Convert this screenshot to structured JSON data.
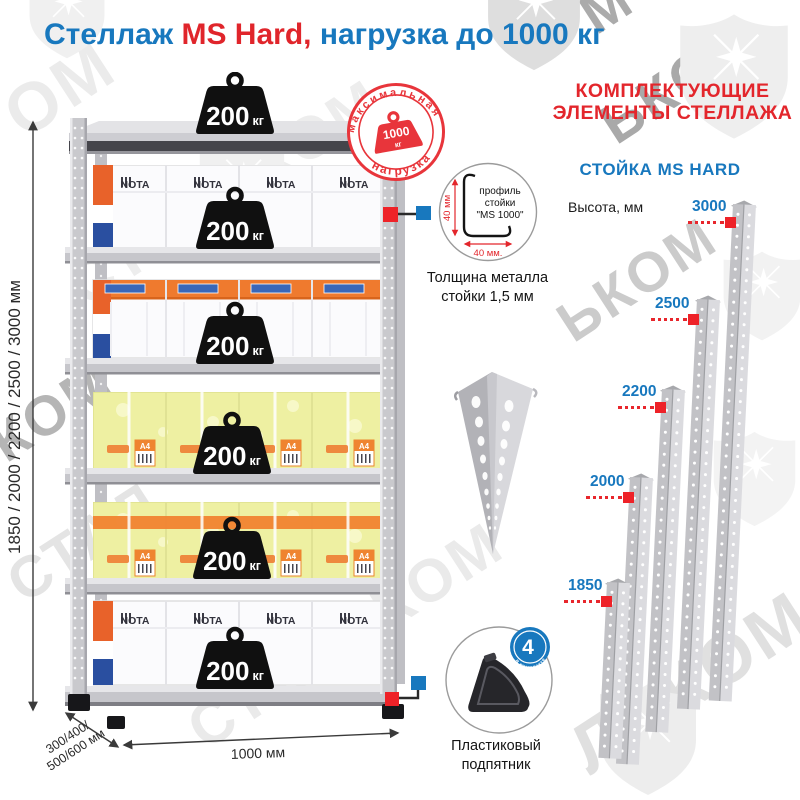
{
  "title": {
    "text_blue_1": "Стеллаж ",
    "text_red": "MS Hard,",
    "text_blue_2": " нагрузка до 1000 кг"
  },
  "colors": {
    "blue": "#1878be",
    "red": "#e3262c",
    "badge_red": "#e8353b",
    "marker_red": "#ee2228",
    "orange": "#ef7a2e",
    "yellow": "#eef0a2"
  },
  "max_load_badge": {
    "arc_top": "максимальная",
    "arc_bottom": "нагрузка",
    "weight_value": "1000",
    "weight_unit": "кг"
  },
  "shelf": {
    "weight_value": "200",
    "weight_unit": "кг",
    "box_brand": "NOTA",
    "box_label": "A4",
    "dim_height": "1850 / 2000 / 2200 / 2500 / 3000 мм",
    "dim_width": "1000 мм",
    "dim_depth_1": "300/400/",
    "dim_depth_2": "500/600 мм"
  },
  "profile_detail": {
    "line1": "профиль",
    "line2": "стойки",
    "line3": "\"MS 1000\"",
    "dim_v": "40 мм",
    "dim_h": "40 мм.",
    "caption_1": "Толщина металла",
    "caption_2": "стойки 1,5 мм"
  },
  "foot_detail": {
    "count": "4",
    "arc_1": "штуки",
    "arc_2": "в комплекте",
    "caption_1": "Пластиковый",
    "caption_2": "подпятник"
  },
  "components": {
    "heading_1": "КОМПЛЕКТУЮЩИЕ",
    "heading_2": "ЭЛЕМЕНТЫ СТЕЛЛАЖА",
    "subheading": "СТОЙКА MS HARD",
    "height_label": "Высота, мм",
    "posts": [
      {
        "height": "3000"
      },
      {
        "height": "2500"
      },
      {
        "height": "2200"
      },
      {
        "height": "2000"
      },
      {
        "height": "1850"
      }
    ]
  },
  "watermark": {
    "brand": "СТАЛЬКОМ",
    "pieces": [
      {
        "text": "ОМ"
      },
      {
        "text": "ЬКОМ"
      },
      {
        "text": "КОМ"
      },
      {
        "text": "СТАЛЬКОМ"
      },
      {
        "text": "ЬКОМ"
      },
      {
        "text": "СТАЛ"
      },
      {
        "text": "СТАЛЬКОМ"
      },
      {
        "text": "ЛЬКОМ"
      },
      {
        "text": "М"
      }
    ]
  }
}
